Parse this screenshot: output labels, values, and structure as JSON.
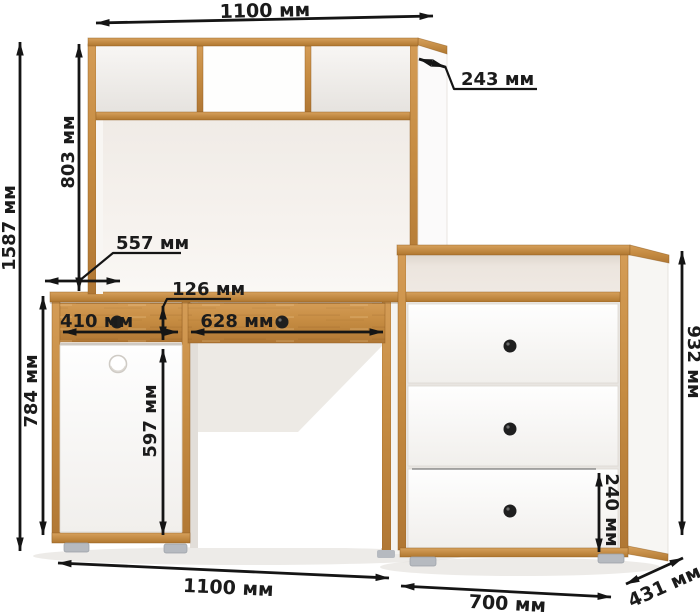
{
  "diagram": {
    "title_hint": "furniture dimension drawing (desk with hutch and chest of drawers)",
    "unit": "мм",
    "dimensions": {
      "top_width": "1100 мм",
      "hutch_depth": "243 мм",
      "total_height": "1587 мм",
      "hutch_height": "803 мм",
      "desk_depth": "557 мм",
      "desk_height": "784 мм",
      "drawer_front_height": "126 мм",
      "left_drawer_width": "410 мм",
      "right_drawer_width": "628 мм",
      "door_height": "597 мм",
      "chest_height": "932 мм",
      "chest_bottom_drawer_height": "240 мм",
      "bottom_width": "1100 мм",
      "chest_width": "700 мм",
      "chest_depth": "431 мм"
    },
    "colors": {
      "wood": "#c68c42",
      "wood_edge": "#8f5c21",
      "panel_white": "#fbfbfa",
      "wall": "#f2eee9",
      "dimension_lines": "#151515",
      "feet": "#b6bac0",
      "knob_black": "#1f1f1f",
      "background": "#ffffff"
    }
  }
}
